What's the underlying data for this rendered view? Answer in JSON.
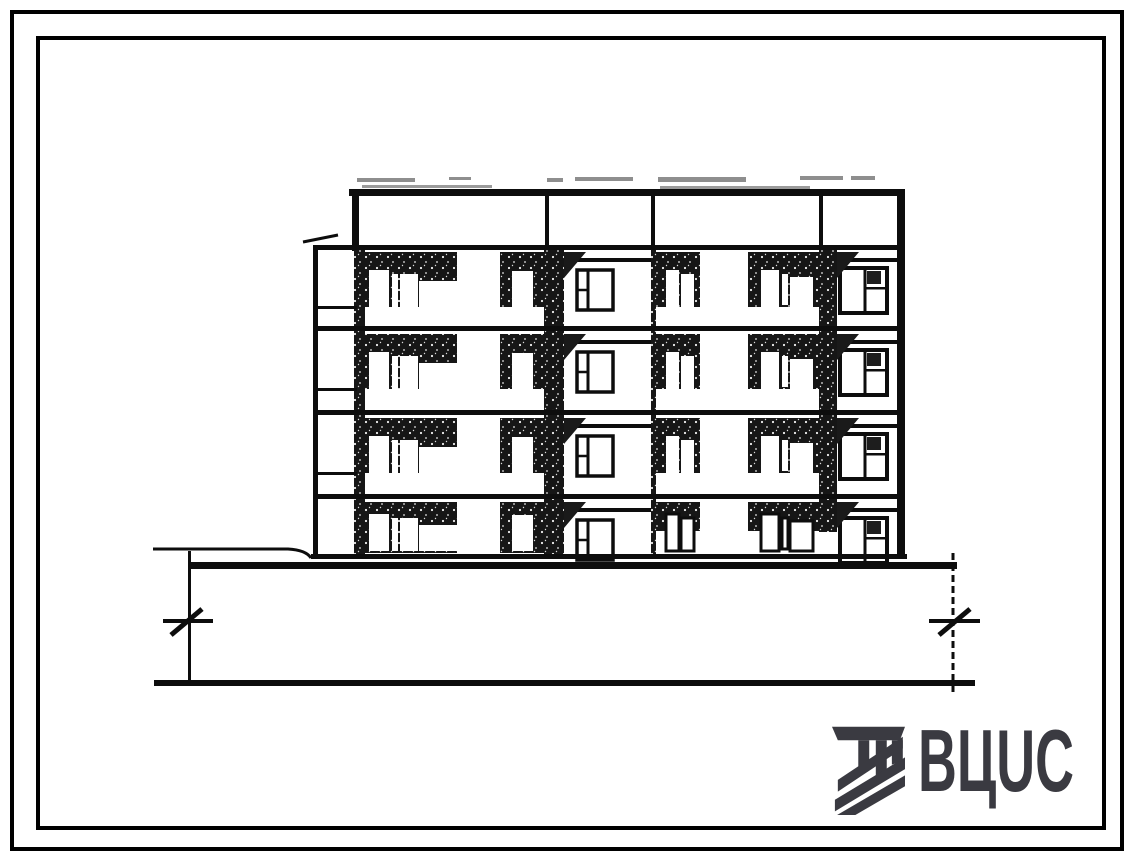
{
  "sheet": {
    "kind": "scanned architectural drawing sheet",
    "subject": "Street facade elevation of a 4-storey large-panel apartment building with recessed balconies, blank end bay at left, basement plinth, ground line and two datum level marks",
    "background": "#ffffff",
    "frames": {
      "color": "#000000",
      "stroke": 4,
      "outer": [
        12,
        12,
        1110,
        837
      ],
      "inner": [
        38,
        38,
        1066,
        790
      ]
    }
  },
  "logo": {
    "text": "ВЦUС",
    "color": "#3a3a41",
    "icon": "construction-hatch-logo-icon"
  },
  "drawing": {
    "colors": {
      "ink": "#0d0d0d",
      "dark_fill": "#161616",
      "smudge": "#8e8e8e",
      "fringe": "#9b9b9b"
    },
    "storeys": [
      {
        "t": 250,
        "b": 326
      },
      {
        "t": 332,
        "b": 410
      },
      {
        "t": 416,
        "b": 494
      },
      {
        "t": 500,
        "b": 554
      }
    ],
    "geometry": {
      "smudges": [
        [
          357,
          178,
          58,
          4
        ],
        [
          449,
          177,
          22,
          3
        ],
        [
          547,
          178,
          16,
          4
        ],
        [
          575,
          177,
          58,
          4
        ],
        [
          658,
          177,
          88,
          5
        ],
        [
          800,
          176,
          43,
          4
        ],
        [
          851,
          176,
          24,
          4
        ]
      ],
      "roof_line": [
        349,
        189,
        556,
        7
      ],
      "roof_fringe": [
        [
          362,
          185,
          130,
          3
        ],
        [
          660,
          186,
          150,
          3
        ]
      ],
      "parapet_bottom_line": [
        313,
        245,
        592,
        5
      ],
      "parapet_verticals": [
        [
          545,
          194,
          4,
          53
        ],
        [
          651,
          194,
          4,
          53
        ],
        [
          819,
          194,
          4,
          53
        ]
      ],
      "left_edge_top": [
        352,
        189,
        7,
        62
      ],
      "right_edge": [
        897,
        189,
        8,
        365
      ],
      "piers": [
        [
          354,
          250,
          11,
          304
        ],
        [
          544,
          250,
          20,
          304
        ],
        [
          651,
          250,
          5,
          304
        ],
        [
          819,
          250,
          18,
          282
        ]
      ],
      "pier_wedges": [
        {
          "x": 564,
          "w": 22,
          "h": 28
        },
        {
          "x": 837,
          "w": 22,
          "h": 28
        }
      ],
      "wing": {
        "wall": [
          313,
          247,
          5,
          307
        ],
        "ledge": [
          303,
          242,
          338,
          235
        ],
        "line_x": 313,
        "line_w": 44,
        "line_dy": 56
      },
      "floor_lines": [
        [
          313,
          326,
          592,
          5
        ],
        [
          313,
          410,
          592,
          5
        ],
        [
          313,
          494,
          592,
          5
        ]
      ],
      "base": {
        "building_line": [
          311,
          554,
          596,
          5
        ],
        "plinth_line": [
          190,
          562,
          767,
          7
        ],
        "ground_left": "M153,549 h135 q18,1 23,9",
        "bottom_line": [
          154,
          680,
          821,
          6
        ],
        "left_vertical": [
          188,
          551,
          3,
          135
        ],
        "right_vertical": [
          953,
          553,
          953,
          692
        ],
        "level_marks": [
          {
            "bar": [
              163,
              619,
              50,
              4
            ],
            "slash": [
              171,
              635,
              202,
              609
            ]
          },
          {
            "bar": [
              929,
              619,
              51,
              4
            ],
            "slash": [
              939,
              635,
              970,
              609
            ]
          }
        ]
      },
      "bays": [
        {
          "kind": "recess",
          "x": 365,
          "w": 92,
          "ground": "dark",
          "windows": [
            [
              369,
              20,
              20,
              38
            ],
            [
              392,
              24,
              6,
              34
            ],
            [
              400,
              24,
              18,
              33
            ],
            [
              419,
              31,
              38,
              26
            ]
          ]
        },
        {
          "kind": "recess",
          "x": 500,
          "w": 44,
          "ground": "dark",
          "windows": [
            [
              512,
              21,
              21,
              39
            ]
          ]
        },
        {
          "kind": "wall",
          "x": 566,
          "w": 85,
          "shadow": [
            566,
            8,
            85,
            4
          ],
          "window": "left"
        },
        {
          "kind": "recess",
          "x": 656,
          "w": 44,
          "ground": "light",
          "windows": [
            [
              666,
              20,
              13,
              38
            ],
            [
              681,
              24,
              13,
              34
            ]
          ]
        },
        {
          "kind": "recess",
          "x": 748,
          "w": 71,
          "ground": "light",
          "windows": [
            [
              761,
              20,
              18,
              38
            ],
            [
              782,
              24,
              6,
              31
            ],
            [
              790,
              27,
              23,
              30
            ]
          ]
        },
        {
          "kind": "wall",
          "x": 837,
          "w": 60,
          "shadow": [
            838,
            8,
            59,
            4
          ],
          "window": "right"
        }
      ],
      "wall_windows": {
        "left": {
          "frame": [
            577,
            20,
            36,
            40
          ],
          "mullion_dx": 11,
          "small_pane": "left",
          "stroke": 3.5
        },
        "right": {
          "frame": [
            840,
            18,
            47,
            45
          ],
          "mullion_dx": 25,
          "small_pane": "right",
          "stroke": 4,
          "vent": [
            867,
            21,
            14,
            13
          ]
        }
      }
    }
  }
}
